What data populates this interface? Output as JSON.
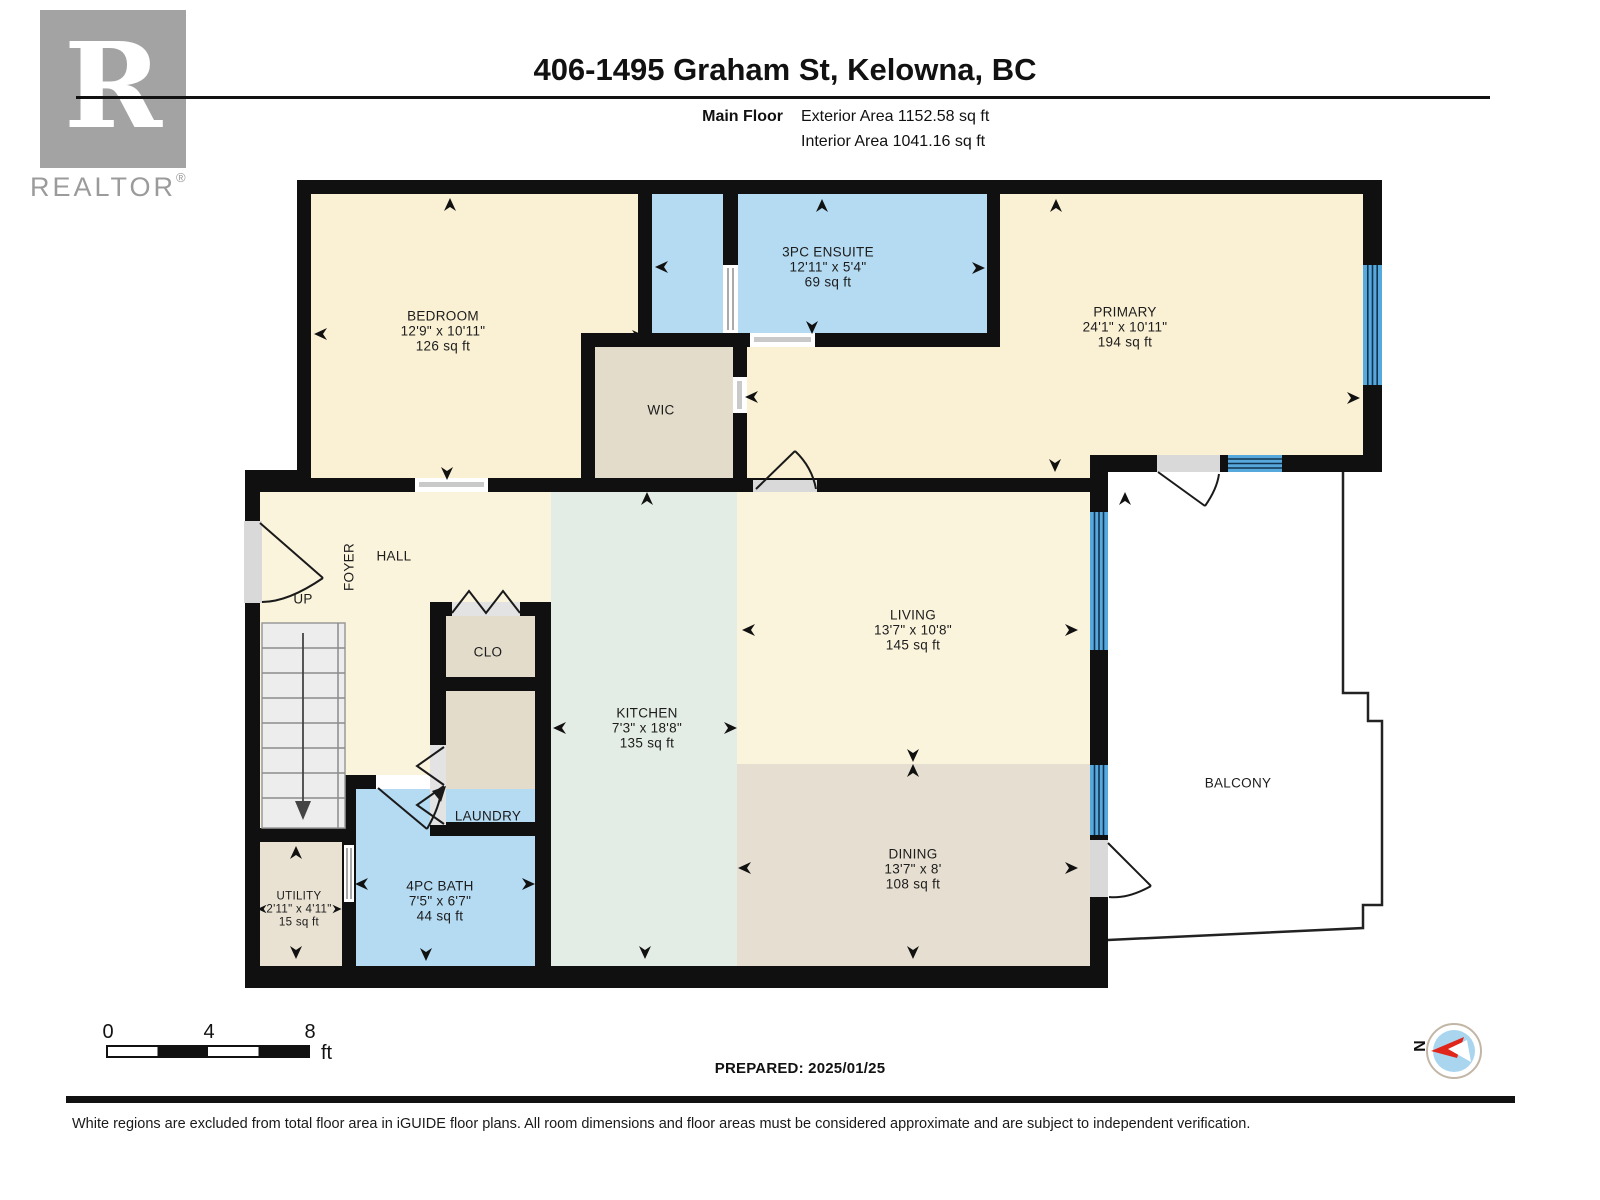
{
  "header": {
    "title": "406-1495 Graham St, Kelowna, BC",
    "floor_label": "Main Floor",
    "exterior_area": "Exterior Area 1152.58 sq ft",
    "interior_area": "Interior Area 1041.16 sq ft"
  },
  "logo": {
    "letter": "R",
    "brand": "REALTOR",
    "registered": "®"
  },
  "rooms": [
    {
      "name": "BEDROOM",
      "dims": "12'9\" x 10'11\"",
      "area": "126 sq ft"
    },
    {
      "name": "3PC ENSUITE",
      "dims": "12'11\" x 5'4\"",
      "area": "69 sq ft"
    },
    {
      "name": "PRIMARY",
      "dims": "24'1\" x 10'11\"",
      "area": "194 sq ft"
    },
    {
      "name": "WIC"
    },
    {
      "name": "FOYER"
    },
    {
      "name": "HALL"
    },
    {
      "name": "UP"
    },
    {
      "name": "CLO"
    },
    {
      "name": "LAUNDRY"
    },
    {
      "name": "KITCHEN",
      "dims": "7'3\" x 18'8\"",
      "area": "135 sq ft"
    },
    {
      "name": "LIVING",
      "dims": "13'7\" x 10'8\"",
      "area": "145 sq ft"
    },
    {
      "name": "DINING",
      "dims": "13'7\" x 8'",
      "area": "108 sq ft"
    },
    {
      "name": "UTILITY",
      "dims": "2'11\" x 4'11\"",
      "area": "15 sq ft"
    },
    {
      "name": "4PC BATH",
      "dims": "7'5\" x 6'7\"",
      "area": "44 sq ft"
    },
    {
      "name": "BALCONY"
    }
  ],
  "scale_bar": {
    "t0": "0",
    "t4": "4",
    "t8": "8",
    "unit": "ft"
  },
  "prepared": "PREPARED: 2025/01/25",
  "compass": {
    "north_label": "N"
  },
  "footer": "White regions are excluded from total floor area in iGUIDE floor plans. All room dimensions and floor areas must be considered approximate and are subject to independent verification.",
  "colors": {
    "wall": "#101010",
    "room_cream": "#FAF1D4",
    "room_beige": "#E3DCCB",
    "utility_beige": "#E9E2D3",
    "room_blue": "#B5DBF3",
    "kitchen_green": "#E4EDE5",
    "dining_tan": "#E6DFD1",
    "window_blue": "#57A8DD",
    "door_gray": "#D9D9D9",
    "compass_red": "#E0251B",
    "compass_blue": "#A9D5EF"
  }
}
